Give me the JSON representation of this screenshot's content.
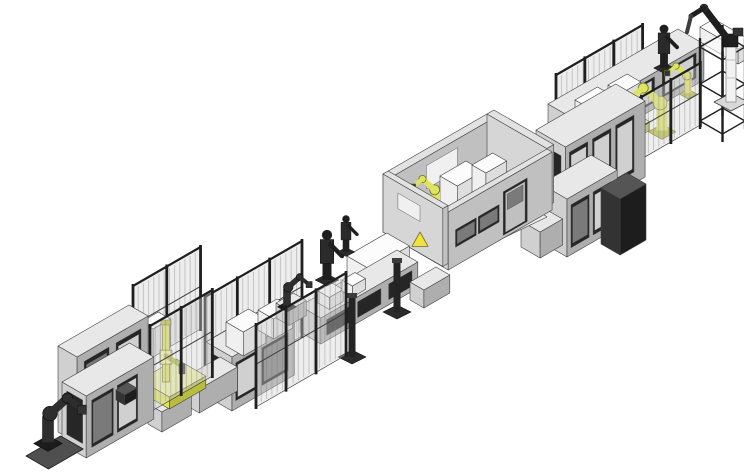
{
  "palette": {
    "outline": "#3f3f3f",
    "gray_top": "#e8e8e8",
    "gray_left": "#d0d0d0",
    "gray_right": "#aeaeae",
    "white_top": "#fcfcfc",
    "white_left": "#f0f0f0",
    "white_right": "#dedede",
    "wall_top": "#e2e2e2",
    "wall_left": "#d6d6d6",
    "wall_front": "#c0c0c0",
    "darkbox_top": "#555555",
    "darkbox_left": "#333333",
    "darkbox_right": "#1d1d1d",
    "yellow_top": "#f1f3a6",
    "yellow_light": "#dfe45e",
    "yellow_dark": "#b8bd40",
    "yellow_outline": "#6e702a",
    "dark": "#1f1f1f",
    "dark2": "#3e3e3e",
    "panel_dark": "#262626",
    "panel_inner": "#7a7a7a",
    "fence_fill": "rgba(210,210,210,0.40)",
    "fence_stripe": "rgba(120,120,120,0.35)",
    "floor": "#ececec",
    "plate": "#4f4f4f",
    "pedestal_white": "#f2f2f2",
    "background": "#ffffff"
  },
  "canvas": {
    "width": 744,
    "height": 475
  },
  "scene": {
    "items": [
      {
        "t": "box",
        "n": "branch-conveyor-top-right",
        "x": 700,
        "y": 42,
        "a": 16,
        "b": 44,
        "h": 15,
        "s": "white"
      },
      {
        "t": "fence",
        "n": "fence-back-right",
        "x": 556,
        "y": 150,
        "a": 100,
        "h": 75,
        "posts": 4
      },
      {
        "t": "box",
        "n": "conveyor-right",
        "x": 548,
        "y": 140,
        "a": 150,
        "b": 30,
        "h": 36,
        "s": "gray",
        "p": [
          [
            "right",
            0.04,
            0.3,
            0.18,
            0.88,
            "panel_dark"
          ],
          [
            "right",
            0.06,
            0.28,
            0.24,
            0.82,
            "gray_left"
          ],
          [
            "right",
            0.36,
            0.62,
            0.18,
            0.88,
            "panel_dark"
          ],
          [
            "right",
            0.38,
            0.6,
            0.24,
            0.82,
            "gray_left"
          ],
          [
            "right",
            0.68,
            0.94,
            0.18,
            0.88,
            "panel_dark"
          ],
          [
            "right",
            0.7,
            0.92,
            0.24,
            0.82,
            "gray_left"
          ]
        ]
      },
      {
        "t": "box",
        "n": "machine-top-right-1",
        "x": 575,
        "y": 116,
        "a": 26,
        "b": 18,
        "h": 16,
        "s": "white"
      },
      {
        "t": "box",
        "n": "machine-top-right-2",
        "x": 608,
        "y": 99,
        "a": 22,
        "b": 16,
        "h": 14,
        "s": "white"
      },
      {
        "t": "figure",
        "n": "robot-operator-right",
        "x": 664,
        "y": 68,
        "sc": 1.3
      },
      {
        "t": "arm",
        "n": "robot-yellow-right-small",
        "x": 688,
        "y": 98,
        "sc": 0.8,
        "dir": -1,
        "c": "yellow"
      },
      {
        "t": "arm",
        "n": "robot-yellow-right-large",
        "x": 662,
        "y": 138,
        "sc": 1.25,
        "dir": -1,
        "c": "yellow"
      },
      {
        "t": "rack",
        "n": "storage-rack",
        "x": 700,
        "y": 128,
        "a": 26,
        "b": 26,
        "h": 88
      },
      {
        "t": "pedestal",
        "n": "robot-pedestal-overhead",
        "x": 731,
        "y": 100
      },
      {
        "t": "box",
        "n": "unit-yellow-right",
        "x": 633,
        "y": 131,
        "a": 10,
        "b": 9,
        "h": 9,
        "s": "yellow"
      },
      {
        "t": "fence",
        "n": "fence-front-right",
        "x": 612,
        "y": 176,
        "a": 102,
        "h": 62,
        "posts": 4
      },
      {
        "t": "box",
        "n": "cabinet-row-back-right",
        "x": 536,
        "y": 206,
        "a": 92,
        "b": 34,
        "h": 76,
        "s": "gray",
        "p": [
          [
            "right",
            0.05,
            0.28,
            0.15,
            0.9,
            "panel_dark"
          ],
          [
            "right",
            0.07,
            0.26,
            0.2,
            0.85,
            "gray_left"
          ],
          [
            "right",
            0.34,
            0.57,
            0.15,
            0.9,
            "panel_dark"
          ],
          [
            "right",
            0.36,
            0.55,
            0.2,
            0.85,
            "gray_left"
          ],
          [
            "right",
            0.63,
            0.86,
            0.15,
            0.9,
            "panel_dark"
          ],
          [
            "right",
            0.65,
            0.84,
            0.2,
            0.85,
            "gray_left"
          ],
          [
            "left",
            0.15,
            0.85,
            0.2,
            0.85,
            "panel_dark"
          ]
        ]
      },
      {
        "t": "box",
        "n": "cabinet-row-front-right",
        "x": 541,
        "y": 242,
        "a": 58,
        "b": 30,
        "h": 58,
        "s": "gray",
        "p": [
          [
            "right",
            0.08,
            0.44,
            0.12,
            0.86,
            "panel_dark"
          ],
          [
            "right",
            0.11,
            0.41,
            0.18,
            0.8,
            "panel_inner"
          ],
          [
            "right",
            0.52,
            0.88,
            0.12,
            0.86,
            "panel_dark"
          ],
          [
            "right",
            0.55,
            0.85,
            0.18,
            0.8,
            "gray_left"
          ]
        ]
      },
      {
        "t": "box",
        "n": "cabinet-dark-right",
        "x": 601,
        "y": 244,
        "a": 30,
        "b": 22,
        "h": 56,
        "s": "darkbox"
      },
      {
        "t": "box",
        "n": "conveyor-room-link",
        "x": 521,
        "y": 247,
        "a": 26,
        "b": 22,
        "h": 26,
        "s": "gray"
      },
      {
        "t": "box",
        "n": "room-wall-back",
        "x": 383,
        "y": 232,
        "a": 120,
        "b": 8,
        "h": 58,
        "s": "wall",
        "p": [
          [
            "right",
            0.35,
            0.65,
            0.45,
            0.85,
            "white_left"
          ]
        ]
      },
      {
        "t": "box",
        "n": "room-wall-right",
        "x": 487,
        "y": 172,
        "a": 8,
        "b": 69,
        "h": 58,
        "s": "wall"
      },
      {
        "t": "floor",
        "n": "room-floor",
        "pts": [
          [
            443,
            267
          ],
          [
            383,
            232
          ],
          [
            487,
            172
          ],
          [
            547,
            217
          ]
        ]
      },
      {
        "t": "box",
        "n": "room-machine-1",
        "x": 440,
        "y": 210,
        "a": 30,
        "b": 20,
        "h": 34,
        "s": "white"
      },
      {
        "t": "box",
        "n": "room-machine-2",
        "x": 472,
        "y": 193,
        "a": 24,
        "b": 16,
        "h": 28,
        "s": "white"
      },
      {
        "t": "box",
        "n": "room-machine-3",
        "x": 452,
        "y": 228,
        "a": 20,
        "b": 14,
        "h": 18,
        "s": "white"
      },
      {
        "t": "arm",
        "n": "robot-room",
        "x": 436,
        "y": 215,
        "sc": 0.9,
        "dir": -1,
        "c": "yellow"
      },
      {
        "t": "box",
        "n": "room-wall-front",
        "x": 443,
        "y": 267,
        "a": 120,
        "b": 6,
        "h": 58,
        "s": "wall",
        "p": [
          [
            "right",
            0.07,
            0.27,
            0.32,
            0.62,
            "panel_dark"
          ],
          [
            "right",
            0.085,
            0.255,
            0.36,
            0.58,
            "panel_inner"
          ],
          [
            "right",
            0.29,
            0.49,
            0.32,
            0.62,
            "panel_dark"
          ],
          [
            "right",
            0.305,
            0.475,
            0.36,
            0.58,
            "panel_inner"
          ],
          [
            "right",
            0.53,
            0.76,
            0.05,
            0.8,
            "panel_dark"
          ],
          [
            "right",
            0.55,
            0.74,
            0.08,
            0.76,
            "wall_front"
          ],
          [
            "right",
            0.57,
            0.72,
            0.45,
            0.72,
            "panel_inner"
          ]
        ]
      },
      {
        "t": "box",
        "n": "room-wall-left",
        "x": 383,
        "y": 232,
        "a": 6,
        "b": 69,
        "h": 58,
        "s": "wall",
        "p": [
          [
            "left",
            0.25,
            0.62,
            0.55,
            0.82,
            "white_left"
          ]
        ]
      },
      {
        "t": "tri",
        "n": "warning-sign",
        "x": 420,
        "y": 241,
        "sc": 9
      },
      {
        "t": "box",
        "n": "station-white-large",
        "x": 347,
        "y": 298,
        "a": 46,
        "b": 26,
        "h": 42,
        "s": "white"
      },
      {
        "t": "box",
        "n": "conveyor-mid",
        "x": 300,
        "y": 332,
        "a": 112,
        "b": 24,
        "h": 26,
        "s": "gray",
        "p": [
          [
            "right",
            0.06,
            0.3,
            0.2,
            0.8,
            "panel_dark"
          ],
          [
            "right",
            0.38,
            0.62,
            0.2,
            0.8,
            "panel_dark"
          ],
          [
            "right",
            0.7,
            0.94,
            0.2,
            0.8,
            "panel_dark"
          ]
        ]
      },
      {
        "t": "box",
        "n": "conveyor-link-room",
        "x": 410,
        "y": 300,
        "a": 30,
        "b": 16,
        "h": 18,
        "s": "gray"
      },
      {
        "t": "box",
        "n": "conveyor-mid-top-1",
        "x": 318,
        "y": 303,
        "a": 16,
        "b": 13,
        "h": 12,
        "s": "white"
      },
      {
        "t": "box",
        "n": "conveyor-mid-top-2",
        "x": 342,
        "y": 291,
        "a": 15,
        "b": 12,
        "h": 11,
        "s": "white"
      },
      {
        "t": "post",
        "n": "stand-post-1",
        "x": 397,
        "y": 310,
        "h": 48
      },
      {
        "t": "post",
        "n": "stand-post-2",
        "x": 352,
        "y": 355,
        "h": 58
      },
      {
        "t": "figure",
        "n": "robot-operator-mid-1",
        "x": 327,
        "y": 280,
        "sc": 1.5
      },
      {
        "t": "figure",
        "n": "robot-operator-mid-2",
        "x": 346,
        "y": 252,
        "sc": 1.1
      },
      {
        "t": "fence",
        "n": "fence-back-mid",
        "x": 205,
        "y": 392,
        "a": 112,
        "h": 95,
        "posts": 4
      },
      {
        "t": "box",
        "n": "cabinet-row-mid",
        "x": 206,
        "y": 396,
        "a": 72,
        "b": 30,
        "h": 54,
        "s": "gray",
        "p": [
          [
            "right",
            0.06,
            0.4,
            0.15,
            0.85,
            "panel_dark"
          ],
          [
            "right",
            0.09,
            0.37,
            0.2,
            0.8,
            "gray_left"
          ],
          [
            "right",
            0.48,
            0.9,
            0.15,
            0.85,
            "panel_dark"
          ],
          [
            "right",
            0.51,
            0.87,
            0.2,
            0.8,
            "panel_inner"
          ],
          [
            "left",
            0.2,
            0.8,
            0.25,
            0.85,
            "panel_dark"
          ]
        ]
      },
      {
        "t": "box",
        "n": "cabinet-mid-top-1",
        "x": 226,
        "y": 346,
        "a": 26,
        "b": 20,
        "h": 24,
        "s": "white"
      },
      {
        "t": "box",
        "n": "cabinet-mid-top-2",
        "x": 258,
        "y": 330,
        "a": 22,
        "b": 18,
        "h": 20,
        "s": "white"
      },
      {
        "t": "box",
        "n": "robot-block-mid",
        "x": 276,
        "y": 318,
        "a": 20,
        "b": 15,
        "h": 15,
        "s": "gray"
      },
      {
        "t": "arm",
        "n": "robot-dark-mid",
        "x": 287,
        "y": 311,
        "sc": 0.85,
        "dir": 1,
        "c": "dark"
      },
      {
        "t": "fence",
        "n": "fence-front-mid",
        "x": 256,
        "y": 407,
        "a": 104,
        "h": 82,
        "posts": 4
      },
      {
        "t": "fence",
        "n": "fence-back-cell",
        "x": 133,
        "y": 368,
        "a": 78,
        "h": 82,
        "posts": 3
      },
      {
        "t": "box",
        "n": "cabinet-cell-back",
        "x": 141,
        "y": 350,
        "a": 20,
        "b": 14,
        "h": 28,
        "s": "white"
      },
      {
        "t": "box",
        "n": "conveyor-cell",
        "x": 182,
        "y": 403,
        "a": 44,
        "b": 20,
        "h": 24,
        "s": "gray"
      },
      {
        "t": "box",
        "n": "conveyor-end-link",
        "x": 148,
        "y": 424,
        "a": 34,
        "b": 16,
        "h": 20,
        "s": "gray"
      },
      {
        "t": "box",
        "n": "robot-cell-base",
        "x": 140,
        "y": 392,
        "a": 42,
        "b": 34,
        "h": 12,
        "s": "yellow"
      },
      {
        "t": "mast",
        "n": "robot-vertical-cell",
        "x": 166,
        "y": 382,
        "h": 58
      },
      {
        "t": "fence",
        "n": "fence-front-cell",
        "x": 150,
        "y": 412,
        "a": 72,
        "h": 86,
        "posts": 3
      },
      {
        "t": "box",
        "n": "machine-end-back",
        "x": 58,
        "y": 432,
        "a": 82,
        "b": 22,
        "h": 86,
        "s": "gray",
        "p": [
          [
            "right",
            0.1,
            0.45,
            0.1,
            0.9,
            "panel_dark"
          ],
          [
            "right",
            0.13,
            0.42,
            0.15,
            0.85,
            "panel_inner"
          ],
          [
            "right",
            0.55,
            0.9,
            0.1,
            0.9,
            "panel_dark"
          ],
          [
            "right",
            0.58,
            0.87,
            0.15,
            0.85,
            "gray_left"
          ]
        ]
      },
      {
        "t": "box",
        "n": "machine-end-front",
        "x": 62,
        "y": 444,
        "a": 78,
        "b": 28,
        "h": 62,
        "s": "gray",
        "p": [
          [
            "left",
            0.2,
            0.85,
            0.2,
            0.9,
            "panel_dark"
          ],
          [
            "right",
            0.08,
            0.4,
            0.12,
            0.88,
            "panel_dark"
          ],
          [
            "right",
            0.1,
            0.38,
            0.17,
            0.83,
            "panel_inner"
          ],
          [
            "right",
            0.46,
            0.76,
            0.12,
            0.88,
            "panel_dark"
          ],
          [
            "right",
            0.48,
            0.74,
            0.17,
            0.83,
            "gray_left"
          ]
        ]
      },
      {
        "t": "box",
        "n": "unit-dark-end",
        "x": 116,
        "y": 400,
        "a": 14,
        "b": 10,
        "h": 10,
        "s": "darkbox"
      },
      {
        "t": "plate",
        "n": "end-base-plate",
        "x": 26,
        "y": 456,
        "a": 40,
        "b": 26
      },
      {
        "t": "arm",
        "n": "robot-end",
        "x": 48,
        "y": 450,
        "sc": 1.3,
        "dir": 1,
        "c": "dark"
      }
    ]
  }
}
